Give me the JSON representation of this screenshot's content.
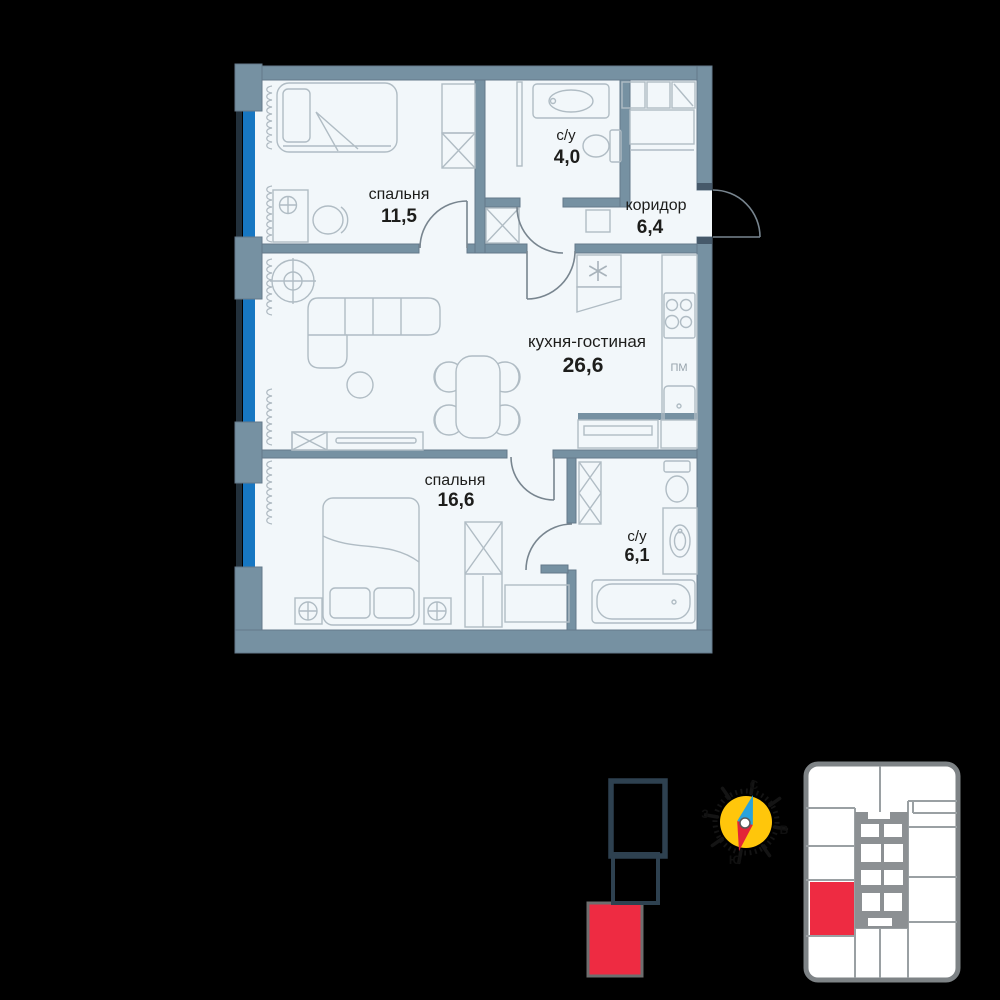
{
  "floor_plan": {
    "rooms": [
      {
        "name": "спальня",
        "area": "11,5"
      },
      {
        "name": "с/у",
        "area": "4,0"
      },
      {
        "name": "коридор",
        "area": "6,4"
      },
      {
        "name": "кухня-гостиная",
        "area": "26,6"
      },
      {
        "name": "спальня",
        "area": "16,6"
      },
      {
        "name": "с/у",
        "area": "6,1"
      }
    ],
    "appliance_labels": {
      "dishwasher": "ПМ"
    }
  },
  "compass": {
    "north": "С",
    "east": "В",
    "south": "Ю",
    "west": "З"
  },
  "colors": {
    "background": "#000000",
    "wall": "#7691a2",
    "room_fill": "#f2f7fa",
    "window_glass": "#1777c2",
    "highlight_red": "#ee2b42",
    "footprint_outline": "#2e4150",
    "compass_yellow": "#ffc60b",
    "needle_blue": "#29a3dd",
    "needle_red": "#e32337"
  }
}
